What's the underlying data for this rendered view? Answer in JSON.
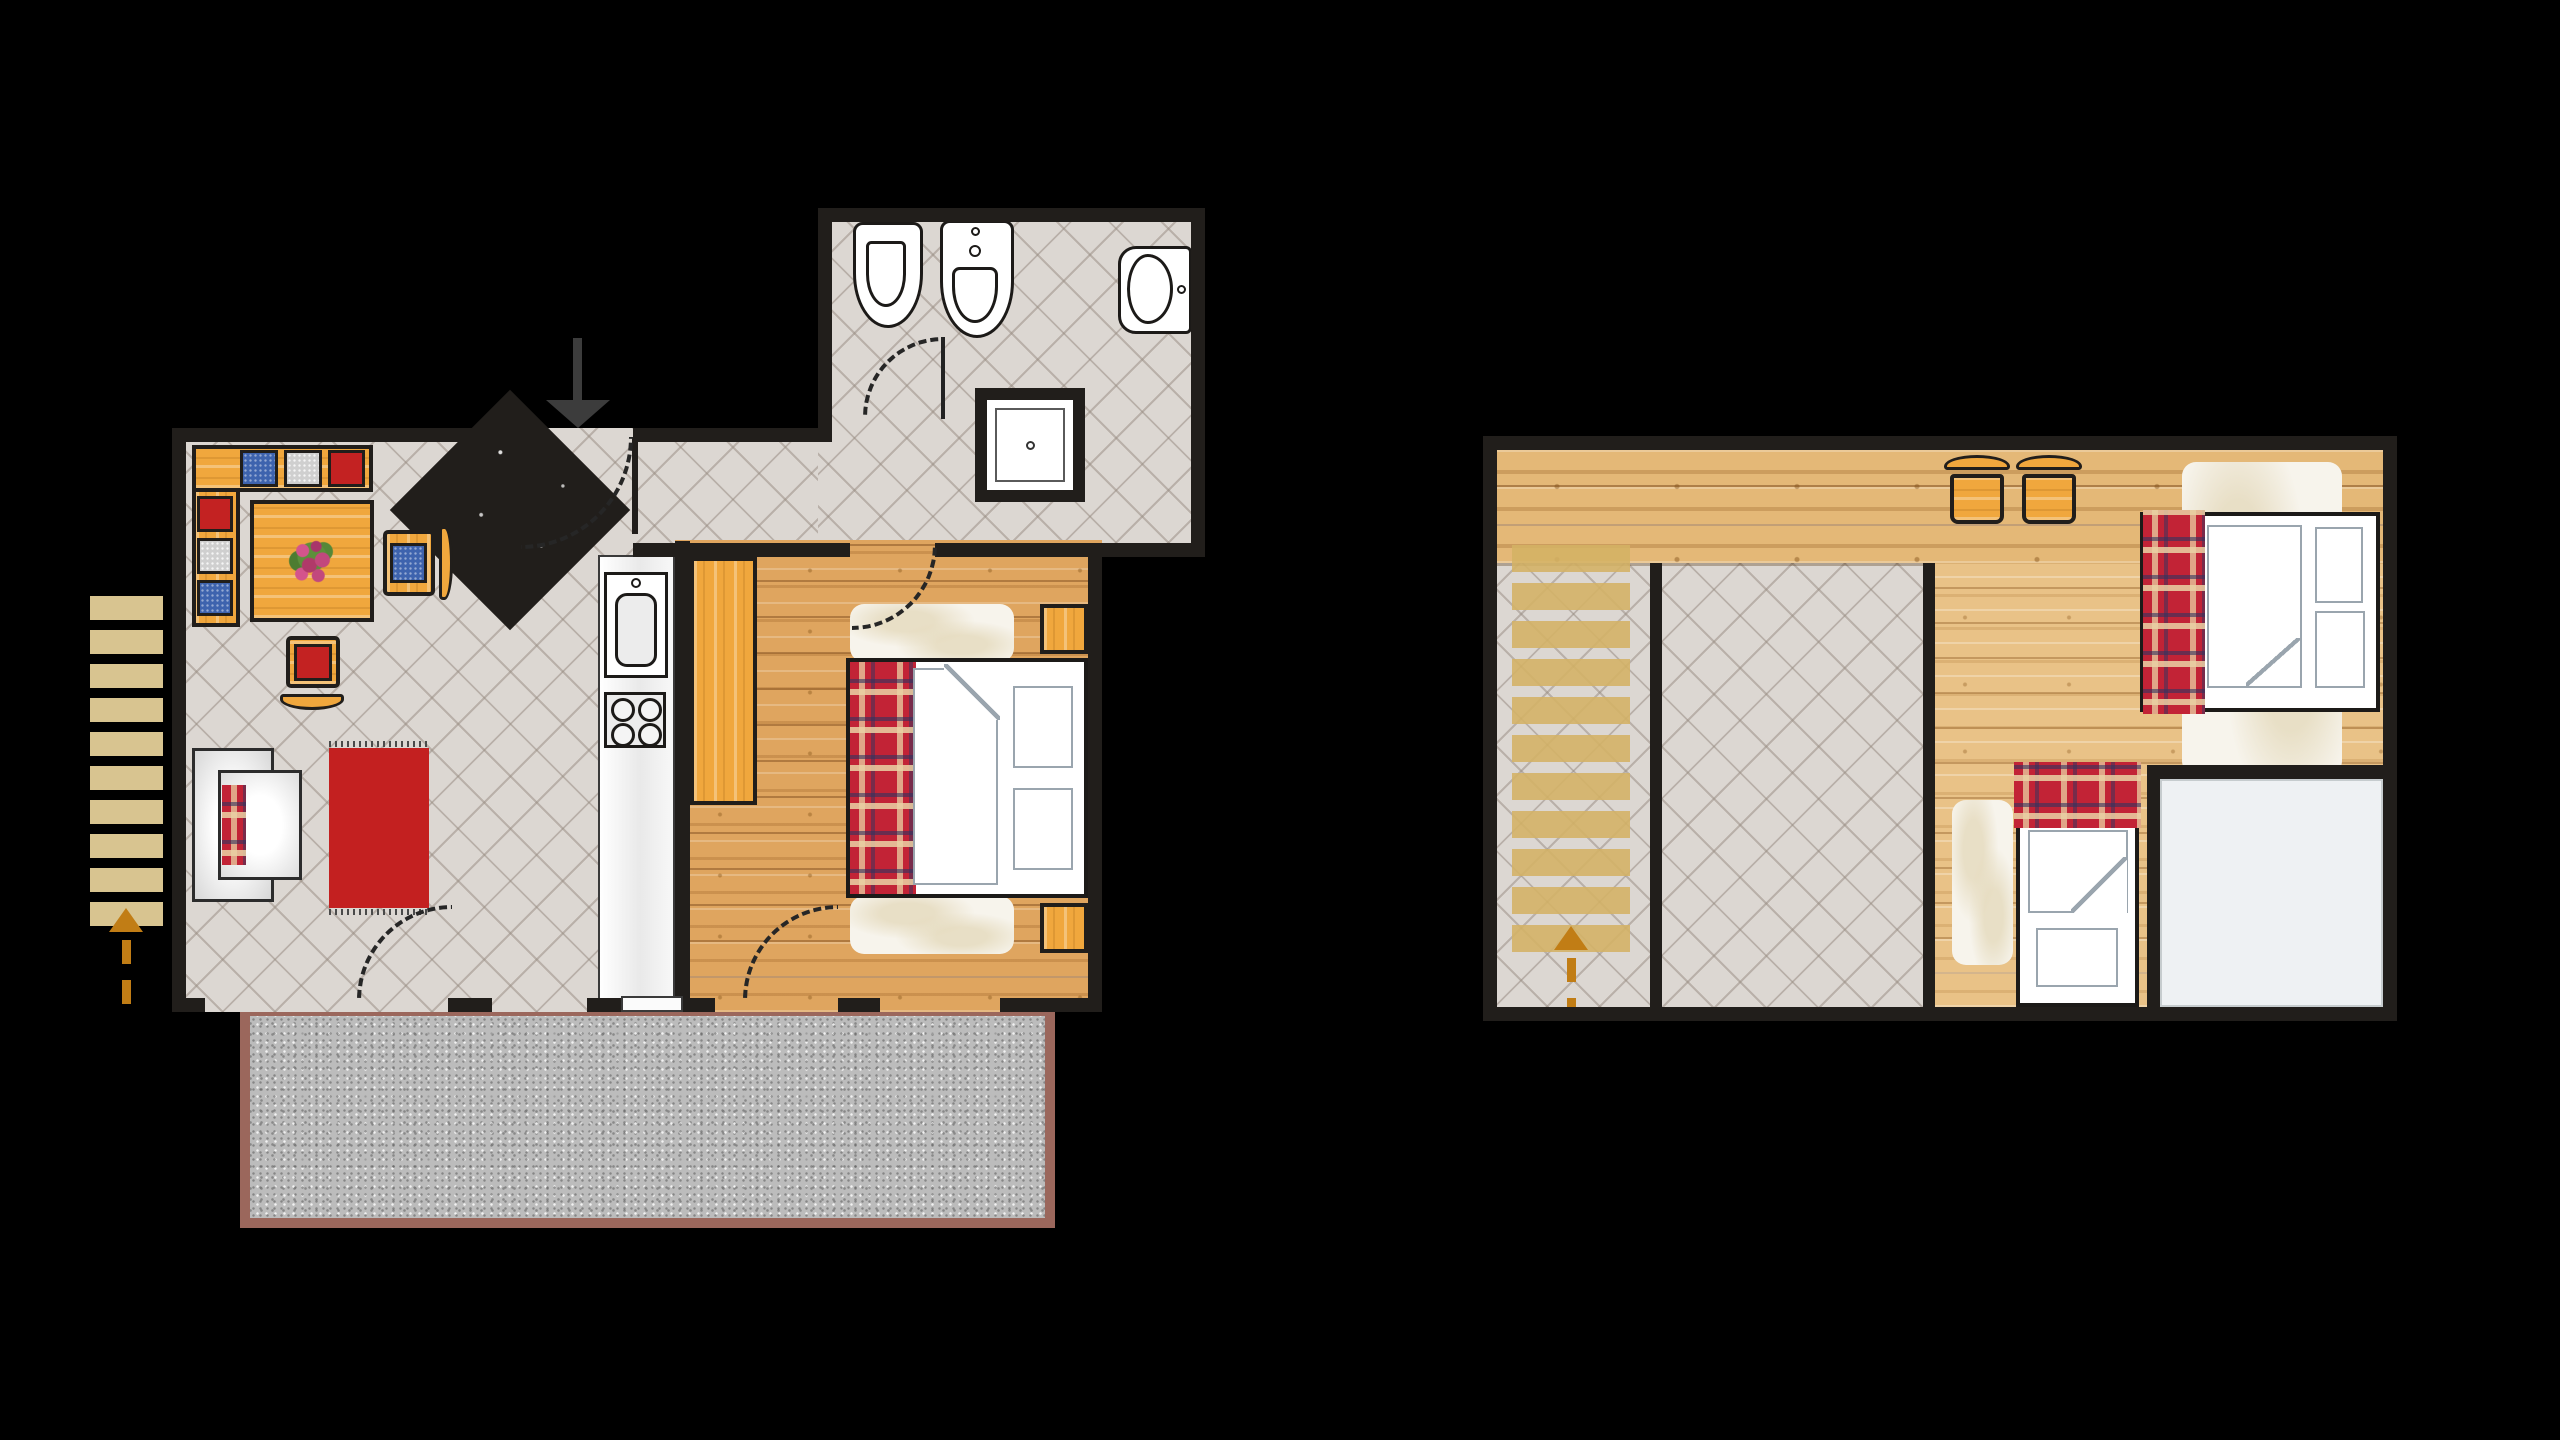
{
  "scene": {
    "type": "floor-plan",
    "floor_count": 2
  },
  "theme": {
    "background": "#000000",
    "wall": "#211e1b",
    "tile": "#dcd7d2",
    "tile_line": "#a89d93",
    "wood_warm": "#dfa55f",
    "wood_light": "#e9c287",
    "furniture_wood": "#f0a73d",
    "counter": "#fafafa",
    "terrace": "#bcbcbc",
    "terrace_border": "#9b675c",
    "cushion_blue": "#3e63ae",
    "cushion_red": "#c32222",
    "cushion_gray": "#cfcfcf",
    "rug_red": "#c32020",
    "plaid_red": "#c22336",
    "plaid_cream": "#ead2a4",
    "plaid_navy": "#2f3460",
    "fur": "#f7f4ec",
    "linen_line": "#9aa5ae",
    "step_tan": "#d8c490",
    "step_upper": "#d4b264",
    "arrow_orange": "#c17d15",
    "arrow_dark": "#262626",
    "fixture_white": "#ffffff",
    "room_white": "#eef1f3",
    "entrance_arrow": "#3c3c3c"
  },
  "ground_floor": {
    "id": "ground-floor",
    "rooms": [
      "living-room",
      "kitchen",
      "bedroom",
      "bathroom",
      "hallway",
      "terrace"
    ],
    "living_room": [
      "corner-bench",
      "bench-cushions-x6",
      "dining-table",
      "flower-centerpiece",
      "chair-with-blue-cushion",
      "chair-with-red-cushion",
      "sofa-with-plaid-blanket",
      "red-fringed-rug"
    ],
    "kitchen": [
      "counter-strip",
      "sink-unit",
      "cooktop-4-burners",
      "wardrobe"
    ],
    "bedroom": [
      "double-bed",
      "plaid-blanket",
      "duvet-with-fold",
      "pillow",
      "pillow",
      "nightstand",
      "nightstand",
      "fur-rug",
      "fur-rug"
    ],
    "bathroom": [
      "bidet",
      "washbasin",
      "toilet",
      "shower",
      "door-leaf"
    ],
    "door_swings": 5,
    "entrance": {
      "type": "diagonal-corner-door",
      "indicator": "black-down-arrow"
    },
    "exterior_stairs": {
      "steps": 10,
      "direction": "up",
      "indicator": "orange-dashed-arrow"
    }
  },
  "upper_floor": {
    "id": "upper-floor",
    "rooms": [
      "loft-bedroom",
      "stairwell",
      "open-void",
      "white-floor-room"
    ],
    "furniture": [
      "chair",
      "chair",
      "double-bed",
      "plaid-blanket",
      "pillow",
      "pillow",
      "single-bed",
      "plaid-blanket",
      "pillow",
      "fur-rug",
      "fur-rug"
    ],
    "stairs": {
      "steps": 11,
      "direction": "up",
      "indicator": "orange-dashed-arrow"
    }
  }
}
